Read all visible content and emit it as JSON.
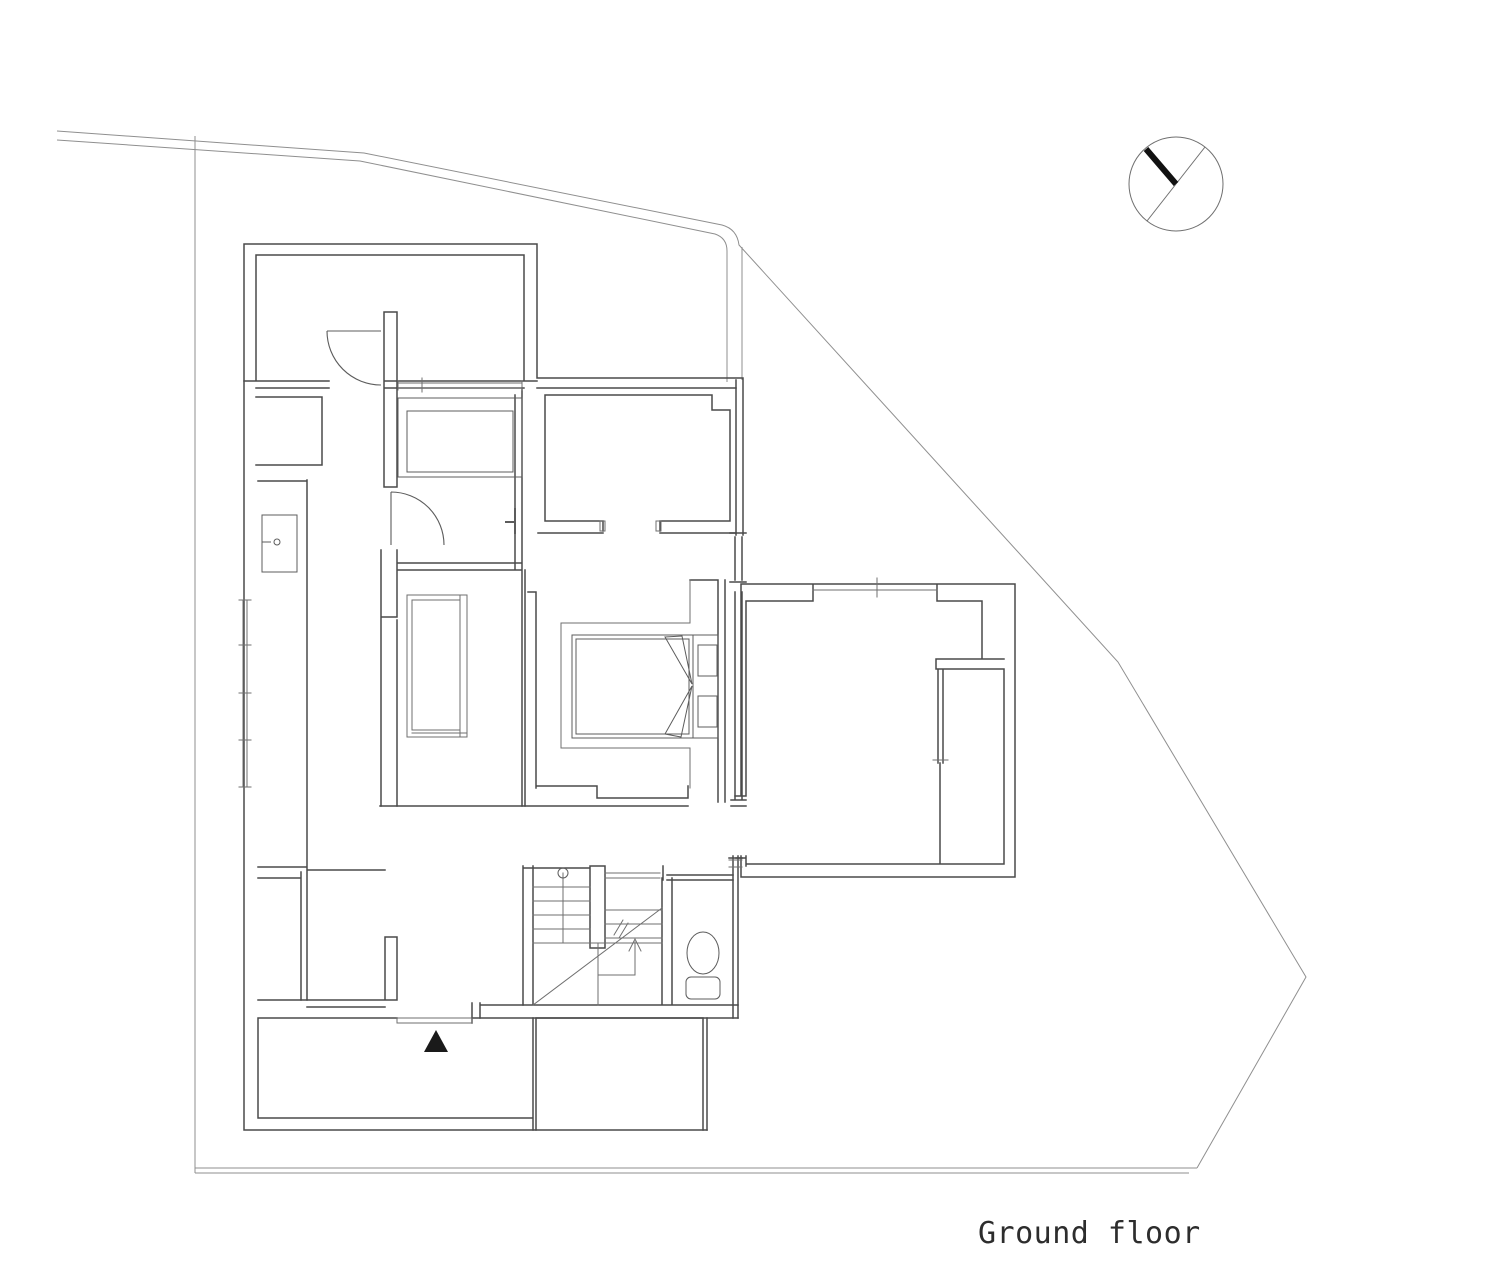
{
  "title": {
    "text": "Ground floor"
  },
  "compass": {
    "name": "north-arrow",
    "direction": "north-up-left"
  },
  "markers": {
    "entrance": "black-triangle-up"
  },
  "colors": {
    "background": "#ffffff",
    "boundary": "#8f8f8f",
    "wall": "#4a4a4a",
    "thin": "#6f6f6f",
    "fixture": "#5c5c5c",
    "door": "#5c5c5c",
    "marker": "#1a1a1a",
    "compass_ring": "#6f6f6f",
    "compass_needle": "#111111",
    "text": "#2d2d2d"
  },
  "elements": [
    "site-boundary",
    "house-walls",
    "top-left-room",
    "bathroom-bathtub",
    "kitchen-sink",
    "tatami-room",
    "bedroom-double-bed",
    "walk-in-closet",
    "staircase",
    "toilet",
    "entrance-porch",
    "right-wing-room",
    "north-arrow"
  ]
}
